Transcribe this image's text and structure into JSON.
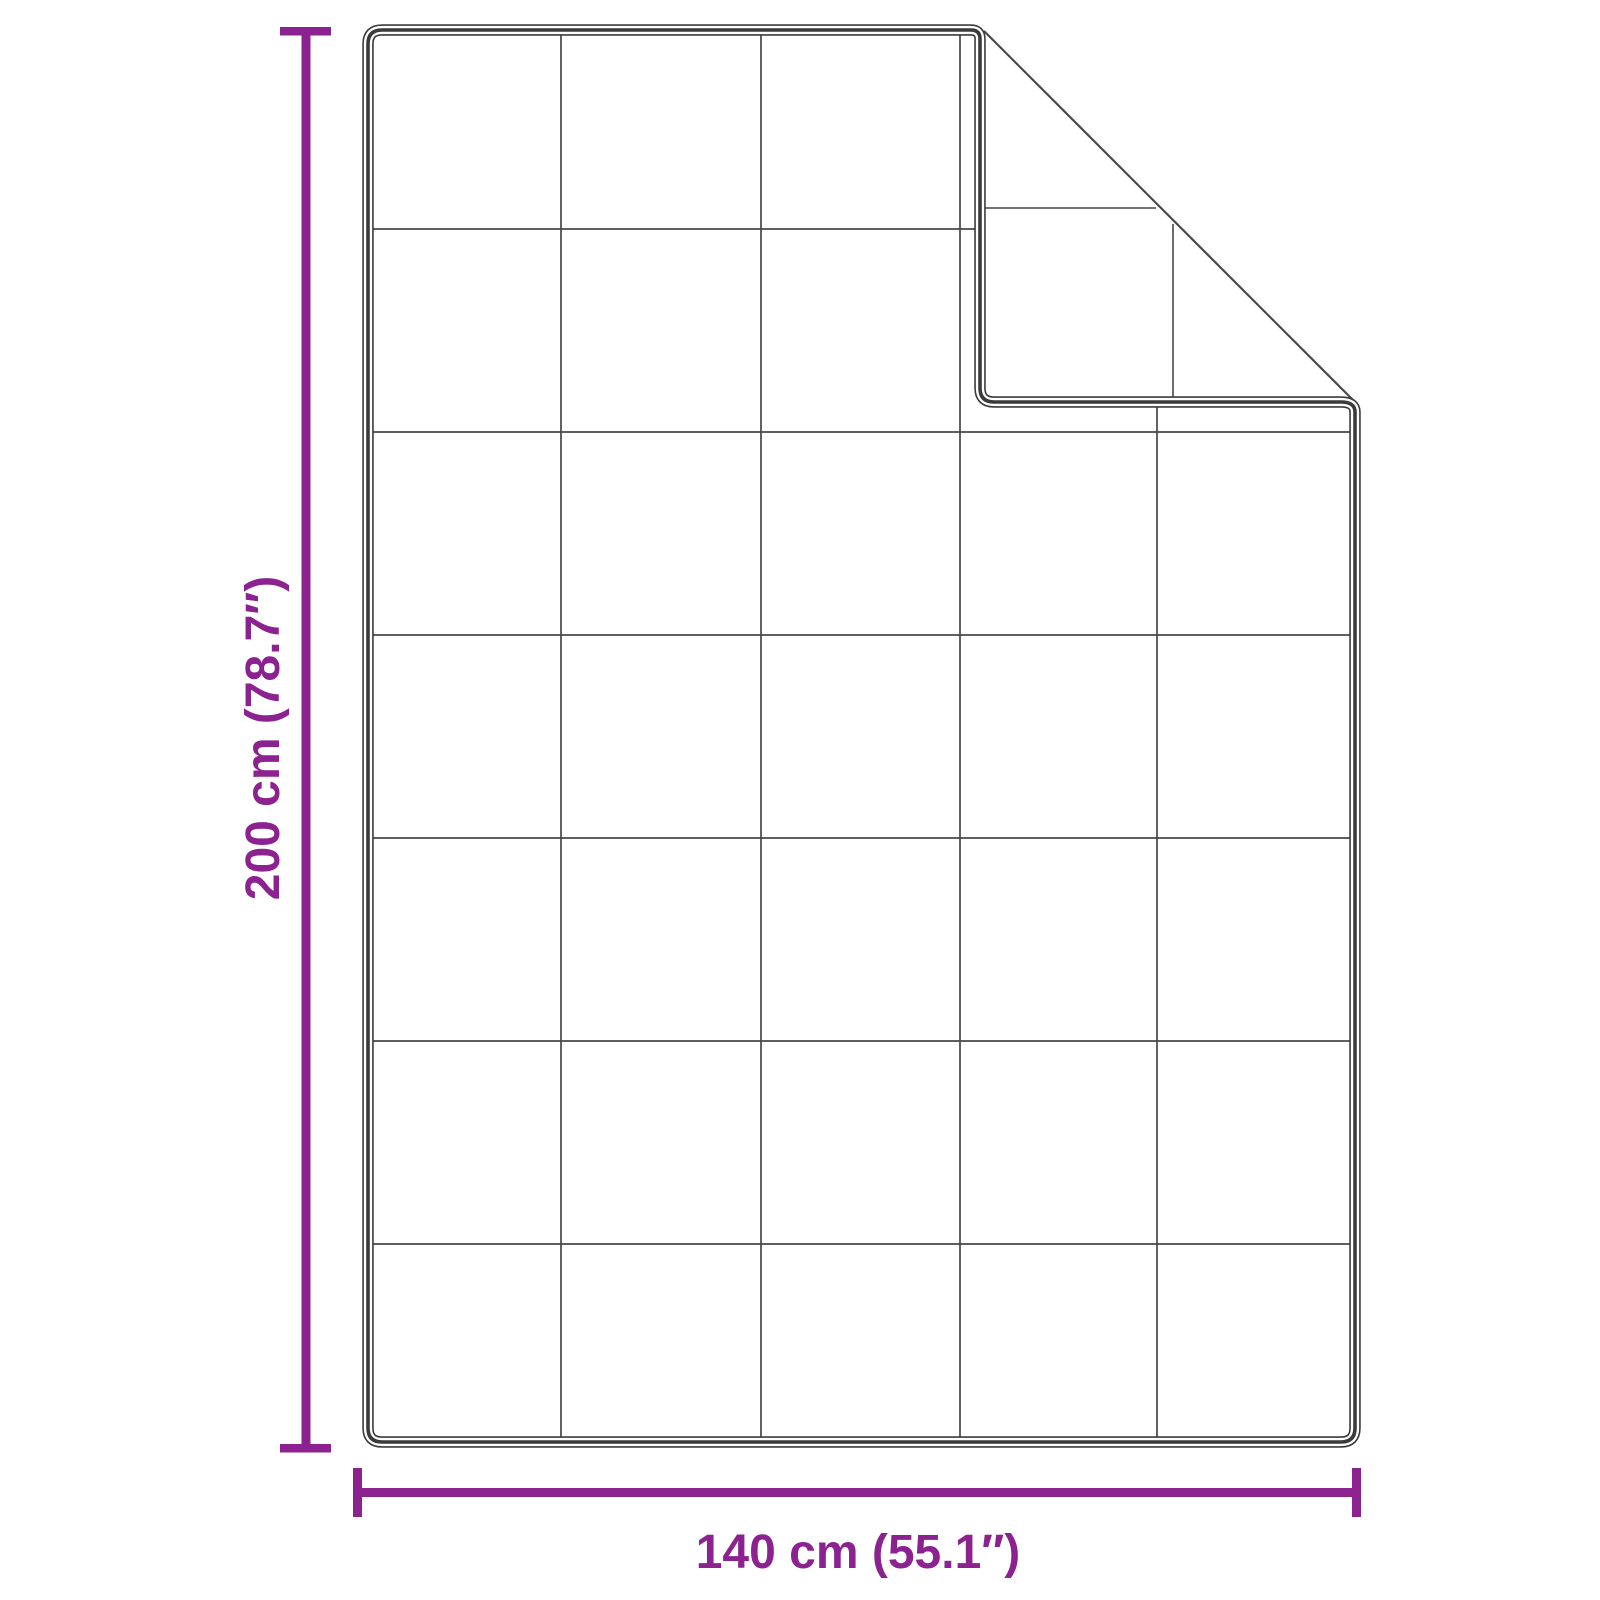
{
  "diagram": {
    "height_label": "200 cm (78.7″)",
    "width_label": "140 cm (55.1″)",
    "grid": {
      "columns": 5,
      "rows": 7
    },
    "colors": {
      "accent": "#8b2290",
      "outline": "#3b3b3b",
      "grid_line": "#474747"
    }
  }
}
